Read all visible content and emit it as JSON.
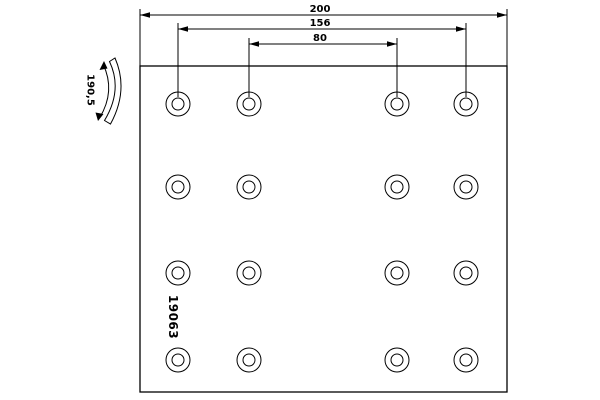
{
  "app": {
    "background_color": "#ffffff",
    "line_color": "#000000"
  },
  "drawing": {
    "type": "brake-lining-technical-drawing",
    "part_number": "19063",
    "dimensions": {
      "overall_width": "200",
      "outer_hole_spacing": "156",
      "inner_hole_spacing": "80",
      "profile_arc_width": "190,5"
    },
    "holes": {
      "count": 16,
      "columns_x": [
        178,
        249,
        397,
        466
      ],
      "rows_y": [
        104,
        187,
        273,
        360
      ],
      "outer_radius": 12,
      "inner_radius": 6
    },
    "plate": {
      "x": 140,
      "y": 66,
      "width": 367,
      "height": 326
    }
  }
}
